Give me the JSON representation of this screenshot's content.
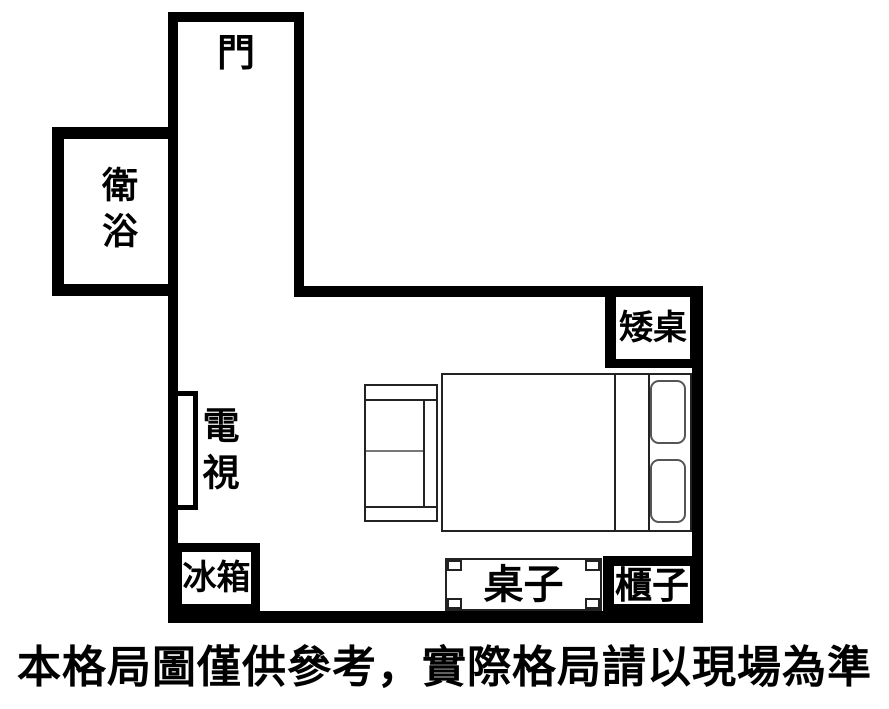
{
  "caption": "本格局圖僅供參考，實際格局請以現場為準",
  "labels": {
    "door": "門",
    "bathroom": "衛浴",
    "tv": "電視",
    "fridge": "冰箱",
    "low_table": "矮桌",
    "table": "桌子",
    "cabinet": "櫃子"
  },
  "colors": {
    "wall": "#000000",
    "background": "#ffffff",
    "furniture_outline": "#222222",
    "pillow_outline": "#555555",
    "cushion_divider": "#777777"
  }
}
